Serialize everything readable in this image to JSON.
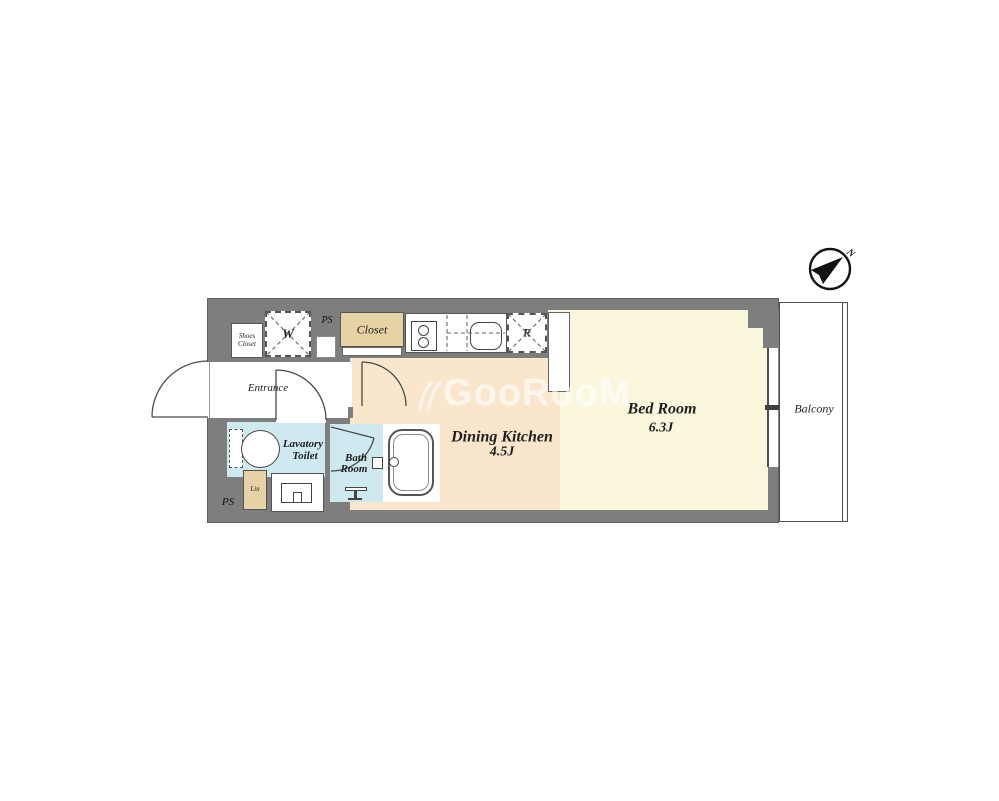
{
  "plan": {
    "compass": {
      "north_label": "N"
    },
    "watermark": {
      "text": "GooRooM"
    },
    "balcony": {
      "label": "Balcony"
    },
    "rooms": {
      "bed_room": {
        "name": "Bed Room",
        "size": "6.3J"
      },
      "dining_kitchen": {
        "name": "Dining Kitchen",
        "size": "4.5J"
      },
      "entrance": {
        "label": "Entrance"
      },
      "lavatory_toilet": {
        "line1": "Lavatory",
        "line2": "Toilet"
      },
      "bath_room": {
        "line1": "Bath",
        "line2": "Room"
      },
      "closet": {
        "label": "Closet"
      },
      "shoes_closet": {
        "line1": "Shoes",
        "line2": "Closet"
      },
      "washer": {
        "label": "W"
      },
      "refrigerator": {
        "label": "R"
      },
      "linen": {
        "label": "Lin"
      },
      "pipe_space_top": {
        "label": "PS"
      },
      "pipe_space_bottom": {
        "label": "PS"
      }
    },
    "colors": {
      "wall": "#7e7e7e",
      "dining_kitchen_floor": "#fae6cc",
      "bed_room_floor": "#fbf7dc",
      "wet_area_floor": "#cfe9f1",
      "closet_fill": "#e6d2a4",
      "line": "#4a4a4a"
    }
  }
}
